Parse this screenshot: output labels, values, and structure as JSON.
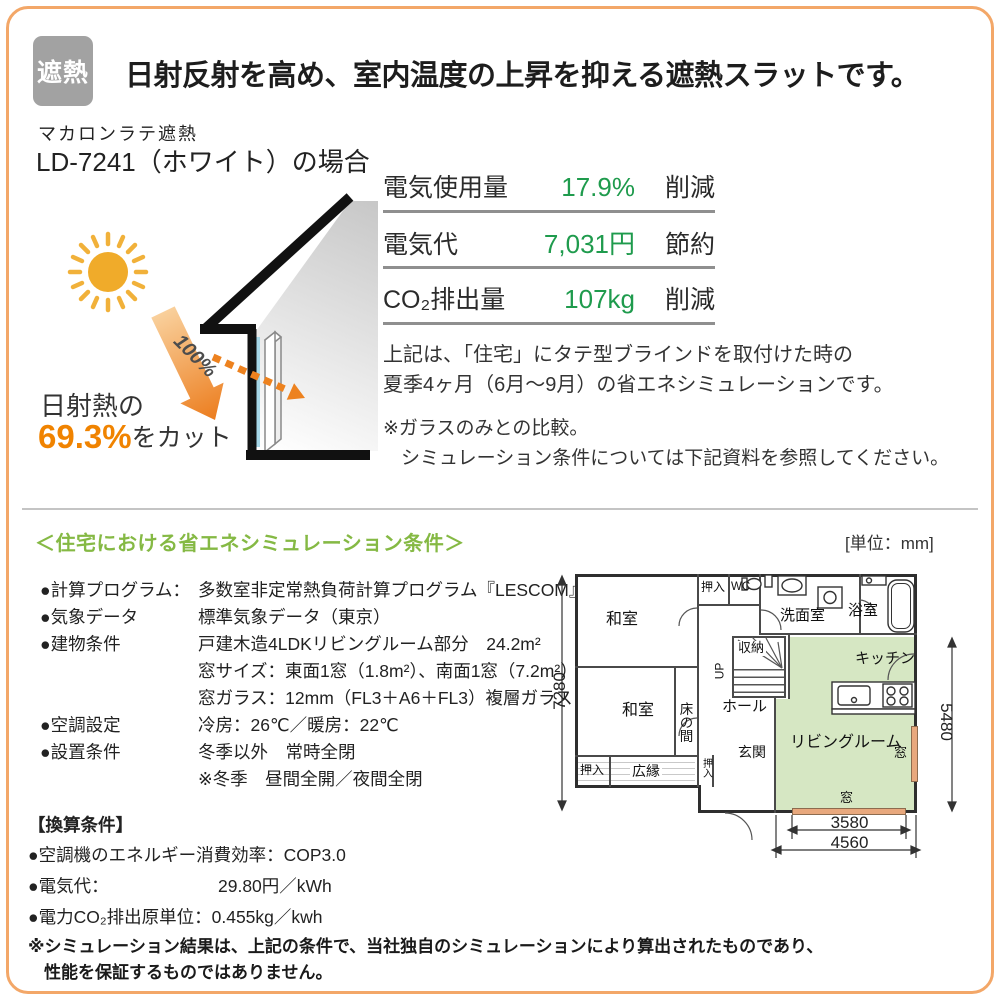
{
  "page": {
    "badge": "遮熱",
    "title": "日射反射を高め、室内温度の上昇を抑える遮熱スラットです。"
  },
  "product": {
    "series": "マカロンラテ遮熱",
    "model": "LD-7241（ホワイト）の場合"
  },
  "diagram": {
    "incident_label": "100%",
    "cut_prefix": "日射熱の",
    "cut_value": "69.3%",
    "cut_suffix": "をカット"
  },
  "energy": {
    "rows": [
      {
        "label": "電気使用量",
        "value": "17.9%",
        "suffix": "削減"
      },
      {
        "label": "電気代",
        "value": "7,031円",
        "suffix": "節約"
      },
      {
        "label": "CO₂排出量",
        "value": "107kg",
        "suffix": "削減"
      }
    ],
    "description_line1": "上記は、「住宅」にタテ型ブラインドを取付けた時の",
    "description_line2": "夏季4ヶ月（6月～9月）の省エネシミュレーションです。",
    "note_line1": "※ガラスのみとの比較。",
    "note_line2": "シミュレーション条件については下記資料を参照してください。"
  },
  "conditions": {
    "heading": "＜住宅における省エネシミュレーション条件＞",
    "unit_label": "[単位：mm]",
    "rows": [
      {
        "label": "●計算プログラム：",
        "content": "多数室非定常熱負荷計算プログラム『LESCOM』"
      },
      {
        "label": "●気象データ",
        "content": "標準気象データ（東京）"
      },
      {
        "label": "●建物条件",
        "content": "戸建木造4LDKリビングルーム部分　24.2m²"
      },
      {
        "label": "",
        "content": "窓サイズ：東面1窓（1.8m²）、南面1窓（7.2m²）"
      },
      {
        "label": "",
        "content": "窓ガラス：12mm（FL3＋A6＋FL3）複層ガラス"
      },
      {
        "label": "●空調設定",
        "content": "冷房：26℃／暖房：22℃"
      },
      {
        "label": "●設置条件",
        "content": "冬季以外　常時全閉"
      },
      {
        "label": "",
        "content": "※冬季　昼間全開／夜間全閉"
      }
    ]
  },
  "conversion": {
    "heading": "【換算条件】",
    "rows": [
      {
        "label": "●空調機のエネルギー消費効率：",
        "value": "COP3.0"
      },
      {
        "label": "●電気代：",
        "value": "29.80円／kWh"
      },
      {
        "label": "●電力CO₂排出原単位：",
        "value": "0.455kg／kwh"
      }
    ]
  },
  "footer": {
    "line1": "※シミュレーション結果は、上記の条件で、当社独自のシミュレーションにより算出されたものであり、",
    "line2": "性能を保証するものではありません。"
  },
  "floorplan": {
    "rooms": {
      "washitsu1": "和室",
      "oshiire_top": "押入",
      "wc": "WC",
      "senmenshitsu": "洗面室",
      "yokushitsu": "浴室",
      "shuno": "収納",
      "up": "UP",
      "kitchen": "キッチン",
      "hall": "ホール",
      "washitsu2": "和室",
      "tokonoma": "床の間",
      "genkan": "玄関",
      "hiroen": "広縁",
      "oshiire_bl": "押入",
      "oshiire_sm": "押入",
      "living": "リビングルーム",
      "mado_right": "窓",
      "mado_bottom": "窓"
    },
    "dims": {
      "left": "7280",
      "right": "5480",
      "inner": "3580",
      "outer": "4560"
    }
  },
  "colors": {
    "frame_orange": "#f3a768",
    "badge_gray": "#a2a2a2",
    "value_green": "#1f9b4d",
    "heading_green": "#85b944",
    "accent_orange": "#f08300",
    "plan_room_green": "#d6e7c3",
    "plan_window_orange": "#e8a87d"
  }
}
